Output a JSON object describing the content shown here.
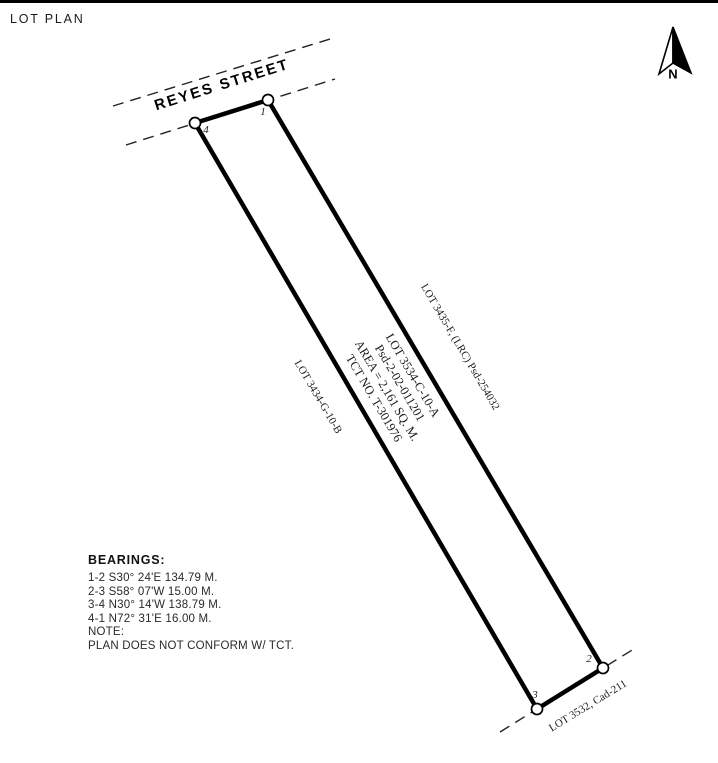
{
  "title": "LOT PLAN",
  "north_arrow": {
    "label": "N"
  },
  "street": {
    "name": "REYES STREET"
  },
  "lot": {
    "center_label": {
      "line1": "LOT 3534-C-10-A",
      "line2": "Psd-2-02-011201",
      "line3": "AREA = 2,161 SQ. M.",
      "line4": "TCT NO. T-301976"
    },
    "neighbors": {
      "right": "LOT 3435-F, (LRC) Psd-254032",
      "left": "LOT 3434-G-10-B",
      "bottom": "LOT 3532, Cad-211"
    },
    "corners": [
      {
        "label": "1"
      },
      {
        "label": "2"
      },
      {
        "label": "3"
      },
      {
        "label": "4"
      }
    ]
  },
  "bearings": {
    "heading": "BEARINGS:",
    "lines": [
      "1-2 S30° 24'E 134.79 M.",
      "2-3 S58° 07'W 15.00 M.",
      "3-4 N30° 14'W 138.79 M.",
      "4-1 N72° 31'E 16.00 M."
    ],
    "note_heading": "NOTE:",
    "note": "PLAN DOES NOT CONFORM W/ TCT."
  },
  "colors": {
    "ink": "#000000",
    "paper": "#ffffff"
  }
}
